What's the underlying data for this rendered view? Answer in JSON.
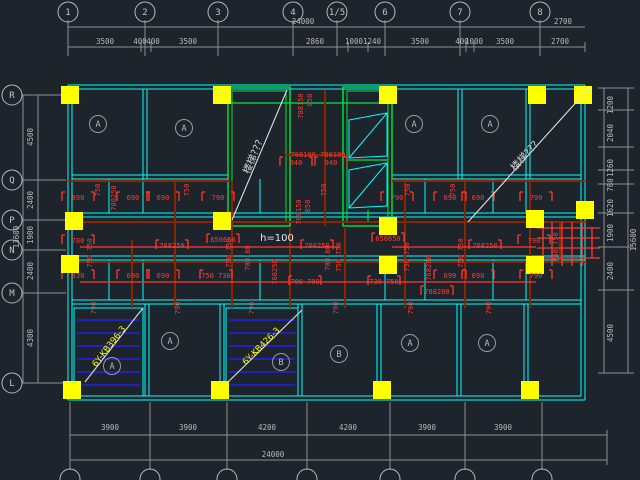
{
  "drawing": {
    "kind": "structural-floor-plan",
    "note_h": "h=100",
    "stair_note": "楼梯???"
  },
  "colors": {
    "background": "#1e242b",
    "walls": "#00ffff",
    "shafts": "#00e63c",
    "columns": "#ffff00",
    "beams": "#8b2500",
    "red_dims": "#ff3b30",
    "gray_dims": "#b9b9b9",
    "hatch": "#2222ee",
    "leader": "#e0e0e0"
  },
  "axes": {
    "top": [
      {
        "t": "1",
        "x": 68
      },
      {
        "t": "2",
        "x": 145
      },
      {
        "t": "3",
        "x": 218
      },
      {
        "t": "4",
        "x": 293
      },
      {
        "t": "1/5",
        "x": 337
      },
      {
        "t": "6",
        "x": 385
      },
      {
        "t": "7",
        "x": 460
      },
      {
        "t": "8",
        "x": 540
      }
    ],
    "left": [
      {
        "t": "R",
        "y": 95
      },
      {
        "t": "Q",
        "y": 180
      },
      {
        "t": "P",
        "y": 220
      },
      {
        "t": "N",
        "y": 250
      },
      {
        "t": "M",
        "y": 293
      },
      {
        "t": "L",
        "y": 383
      }
    ]
  },
  "dims": {
    "top_total": {
      "t": "24000",
      "x": 303,
      "y": 24
    },
    "top_total_right": {
      "t": "2700",
      "x": 563,
      "y": 24
    },
    "top_row": [
      {
        "t": "3500",
        "x": 105
      },
      {
        "t": "400",
        "x": 140
      },
      {
        "t": "400",
        "x": 153
      },
      {
        "t": "3500",
        "x": 188
      },
      {
        "t": "2860",
        "x": 315
      },
      {
        "t": "1000",
        "x": 354
      },
      {
        "t": "1240",
        "x": 372
      },
      {
        "t": "3500",
        "x": 420
      },
      {
        "t": "400",
        "x": 462
      },
      {
        "t": "1000",
        "x": 474
      },
      {
        "t": "3500",
        "x": 505
      },
      {
        "t": "2700",
        "x": 560
      }
    ],
    "left_row": [
      {
        "t": "4500",
        "y": 137
      },
      {
        "t": "2400",
        "y": 200
      },
      {
        "t": "1900",
        "y": 235
      },
      {
        "t": "2400",
        "y": 271
      },
      {
        "t": "4300",
        "y": 338
      }
    ],
    "left_total": {
      "t": "13600",
      "x": 19,
      "y": 237
    },
    "right_row": [
      {
        "t": "1200",
        "y": 105
      },
      {
        "t": "2040",
        "y": 133
      },
      {
        "t": "1260",
        "y": 168
      },
      {
        "t": "780",
        "y": 185
      },
      {
        "t": "1620",
        "y": 208
      },
      {
        "t": "1900",
        "y": 233
      },
      {
        "t": "2400",
        "y": 271
      },
      {
        "t": "4500",
        "y": 333
      }
    ],
    "right_total": {
      "t": "15600",
      "x": 636,
      "y": 240
    },
    "bottom_row": [
      {
        "t": "3900",
        "x": 110
      },
      {
        "t": "3900",
        "x": 188
      },
      {
        "t": "4200",
        "x": 267
      },
      {
        "t": "4200",
        "x": 348
      },
      {
        "t": "3900",
        "x": 427
      },
      {
        "t": "3900",
        "x": 503
      }
    ],
    "bottom_total": {
      "t": "24000",
      "x": 273,
      "y": 457
    }
  },
  "red_dims": [
    {
      "t": "890",
      "x": 78,
      "y": 200
    },
    {
      "t": "690",
      "x": 133,
      "y": 200
    },
    {
      "t": "690",
      "x": 163,
      "y": 200
    },
    {
      "t": "790",
      "x": 218,
      "y": 200
    },
    {
      "t": "790",
      "x": 397,
      "y": 200
    },
    {
      "t": "690",
      "x": 450,
      "y": 200
    },
    {
      "t": "690",
      "x": 478,
      "y": 200
    },
    {
      "t": "790",
      "x": 536,
      "y": 200
    },
    {
      "t": "750",
      "x": 100,
      "y": 190,
      "r": -90
    },
    {
      "t": "750",
      "x": 189,
      "y": 190,
      "r": -90
    },
    {
      "t": "750",
      "x": 326,
      "y": 190,
      "r": -90
    },
    {
      "t": "750",
      "x": 410,
      "y": 190,
      "r": -90
    },
    {
      "t": "750",
      "x": 455,
      "y": 190,
      "r": -90
    },
    {
      "t": "780250",
      "x": 116,
      "y": 198,
      "r": -90
    },
    {
      "t": "788150",
      "x": 303,
      "y": 106,
      "r": -90
    },
    {
      "t": "850",
      "x": 312,
      "y": 100,
      "r": -90
    },
    {
      "t": "788100 788100",
      "x": 318,
      "y": 157
    },
    {
      "t": "940",
      "x": 296,
      "y": 165
    },
    {
      "t": "940",
      "x": 331,
      "y": 165
    },
    {
      "t": "788150",
      "x": 301,
      "y": 212,
      "r": -90
    },
    {
      "t": "850",
      "x": 310,
      "y": 206,
      "r": -90
    },
    {
      "t": "780",
      "x": 78,
      "y": 243
    },
    {
      "t": "768250",
      "x": 172,
      "y": 248
    },
    {
      "t": "650650",
      "x": 223,
      "y": 242
    },
    {
      "t": "760250",
      "x": 317,
      "y": 248
    },
    {
      "t": "650650",
      "x": 388,
      "y": 241
    },
    {
      "t": "768250",
      "x": 485,
      "y": 248
    },
    {
      "t": "790",
      "x": 534,
      "y": 243
    },
    {
      "t": "750 750",
      "x": 92,
      "y": 253,
      "r": -90
    },
    {
      "t": "750 750",
      "x": 231,
      "y": 253,
      "r": -90
    },
    {
      "t": "750 750",
      "x": 341,
      "y": 257,
      "r": -90
    },
    {
      "t": "750 750",
      "x": 409,
      "y": 257,
      "r": -90
    },
    {
      "t": "750 750",
      "x": 463,
      "y": 253,
      "r": -90
    },
    {
      "t": "750 750",
      "x": 558,
      "y": 247,
      "r": -90
    },
    {
      "t": "768250",
      "x": 277,
      "y": 272,
      "r": -90
    },
    {
      "t": "768250",
      "x": 431,
      "y": 268,
      "r": -90
    },
    {
      "t": "780180",
      "x": 250,
      "y": 258,
      "r": -90
    },
    {
      "t": "780180",
      "x": 330,
      "y": 258,
      "r": -90
    },
    {
      "t": "830",
      "x": 78,
      "y": 278
    },
    {
      "t": "690",
      "x": 133,
      "y": 278
    },
    {
      "t": "690",
      "x": 163,
      "y": 278
    },
    {
      "t": "750 730",
      "x": 216,
      "y": 278
    },
    {
      "t": "700 700",
      "x": 305,
      "y": 284
    },
    {
      "t": "730 750",
      "x": 384,
      "y": 284
    },
    {
      "t": "690",
      "x": 450,
      "y": 278
    },
    {
      "t": "690",
      "x": 478,
      "y": 278
    },
    {
      "t": "790",
      "x": 536,
      "y": 278
    },
    {
      "t": "788200",
      "x": 437,
      "y": 294
    },
    {
      "t": "790",
      "x": 96,
      "y": 308,
      "r": -90
    },
    {
      "t": "790",
      "x": 180,
      "y": 308,
      "r": -90
    },
    {
      "t": "790",
      "x": 254,
      "y": 308,
      "r": -90
    },
    {
      "t": "790",
      "x": 338,
      "y": 308,
      "r": -90
    },
    {
      "t": "790",
      "x": 413,
      "y": 308,
      "r": -90
    },
    {
      "t": "790",
      "x": 491,
      "y": 308,
      "r": -90
    }
  ],
  "rooms": [
    {
      "t": "A",
      "x": 98,
      "y": 124
    },
    {
      "t": "A",
      "x": 184,
      "y": 128
    },
    {
      "t": "A",
      "x": 414,
      "y": 124
    },
    {
      "t": "A",
      "x": 490,
      "y": 124
    },
    {
      "t": "A",
      "x": 112,
      "y": 366
    },
    {
      "t": "A",
      "x": 170,
      "y": 341
    },
    {
      "t": "B",
      "x": 281,
      "y": 362
    },
    {
      "t": "B",
      "x": 339,
      "y": 354
    },
    {
      "t": "A",
      "x": 410,
      "y": 343
    },
    {
      "t": "A",
      "x": 487,
      "y": 343
    }
  ],
  "notes": {
    "h": {
      "t": "h=100",
      "x": 277,
      "y": 241
    },
    "stairs": [
      {
        "t": "楼梯???",
        "x": 256,
        "y": 158,
        "r": -67
      },
      {
        "t": "楼梯???",
        "x": 527,
        "y": 158,
        "r": -48
      }
    ],
    "slabs": [
      {
        "t": "6Y-KB396-3",
        "x": 111,
        "y": 348,
        "r": -52
      },
      {
        "t": "6Y-KB426-3",
        "x": 263,
        "y": 348,
        "r": -45
      }
    ]
  }
}
